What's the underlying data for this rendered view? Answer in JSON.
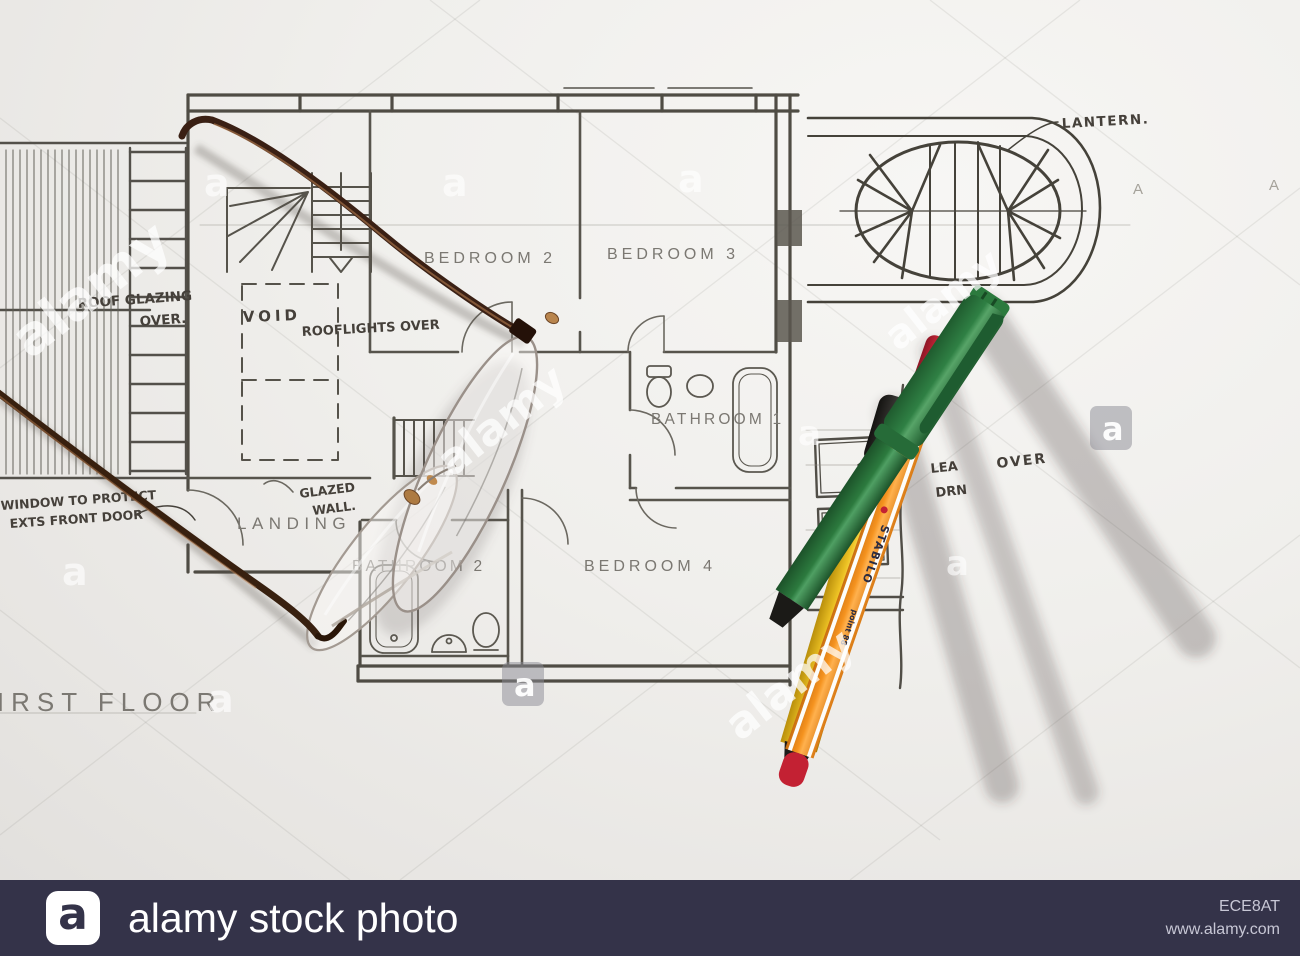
{
  "plan": {
    "labels": {
      "bedroom2": "BEDROOM 2",
      "bedroom3": "BEDROOM 3",
      "bathroom1": "BATHROOM 1",
      "bedroom4": "BEDROOM 4",
      "bathroom2": "BATHROOM 2",
      "landing": "LANDING",
      "first_floor": "FIRST FLOOR",
      "section_marker_left": "A",
      "section_marker_right": "A"
    },
    "annotations": {
      "lantern": "LANTERN.",
      "roof_glazing_line1": "ROOF GLAZING",
      "roof_glazing_line2": "OVER.",
      "rooflights": "ROOFLIGHTS OVER",
      "glazed_wall_line1": "GLAZED",
      "glazed_wall_line2": "WALL.",
      "void": "VOID",
      "window_note_line1": "WINDOW TO PROTECT",
      "window_note_line2": "EXTS FRONT DOOR",
      "partial_note_frag1": "LEA",
      "partial_note_over": "OVER",
      "partial_note_frag2": "DRN"
    }
  },
  "pens": {
    "yellow": {
      "body_color": "#e9b90e",
      "cap_color": "#1e1d1b"
    },
    "orange": {
      "body_color": "#f59220",
      "cap_color": "#c32133",
      "brand": "STABILO",
      "model": "point 88"
    },
    "green": {
      "body_color": "#2d7b40",
      "tip_color": "#1b1a17"
    }
  },
  "watermark": {
    "brand": "alamy",
    "letter": "a"
  },
  "footer": {
    "letter": "a",
    "brand": "alamy stock photo",
    "image_id": "ECE8AT",
    "url": "www.alamy.com",
    "bar_color": "#343349"
  }
}
